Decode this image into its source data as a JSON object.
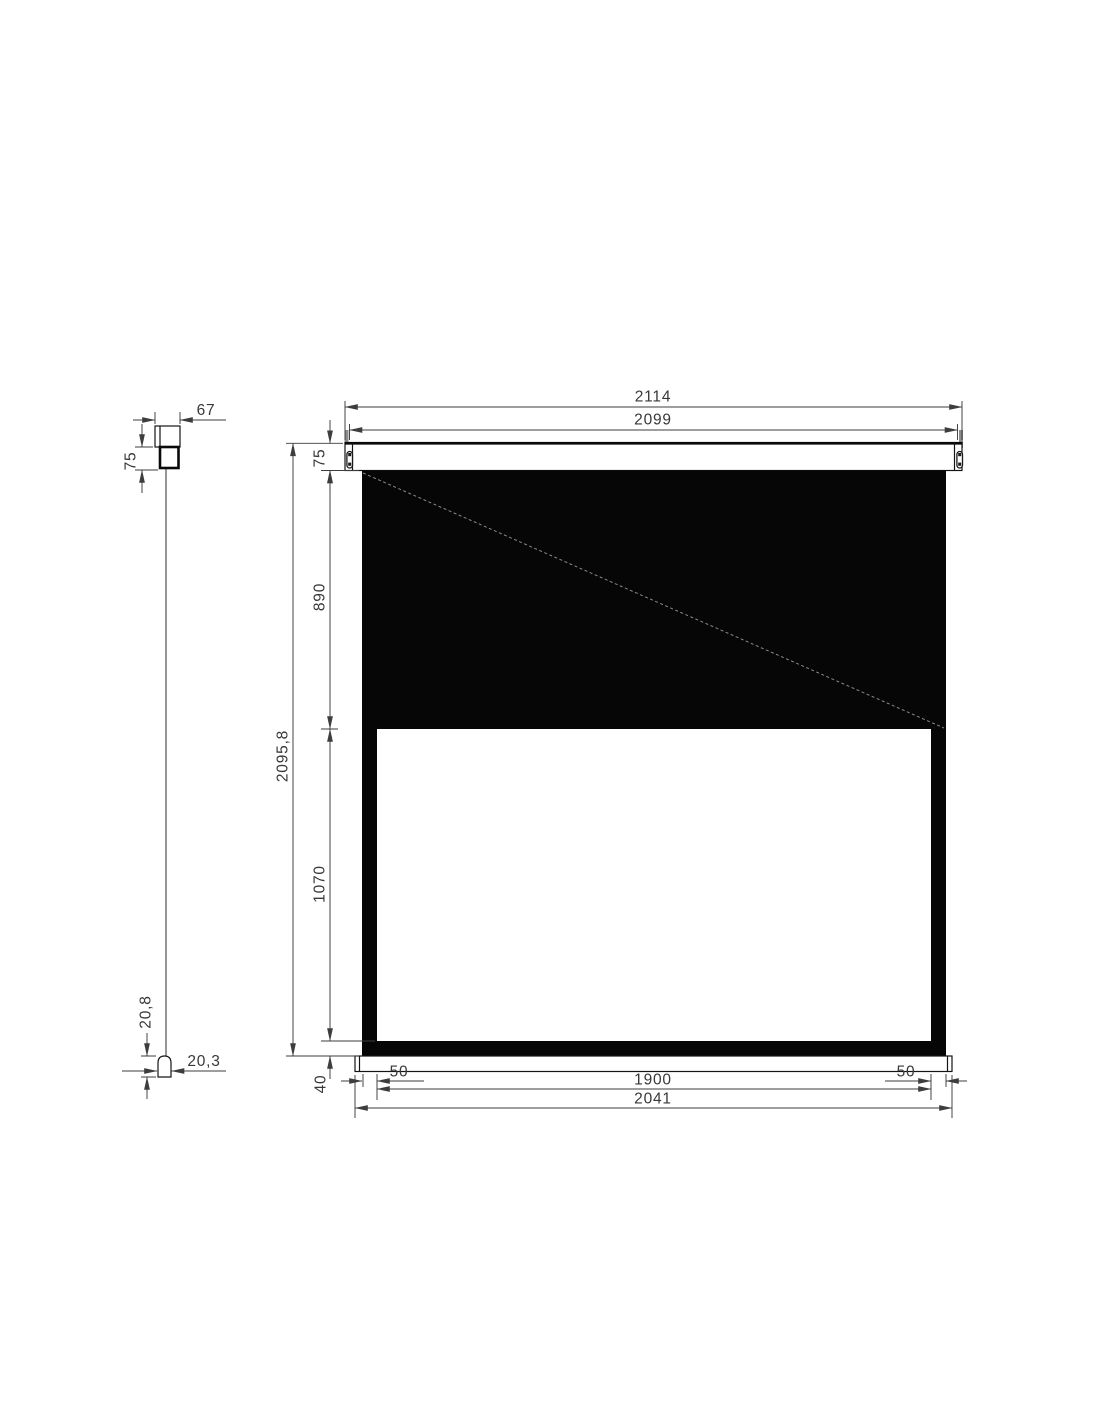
{
  "drawing": {
    "title": "Projection screen dimensional drawing",
    "units": "mm",
    "views": {
      "side": "side profile",
      "front": "front elevation"
    }
  },
  "colors": {
    "fabric_black": "#060606",
    "line": "#141414",
    "dimension": "#3d3d3d",
    "bracket_gray": "#8c8c8c"
  },
  "dims": {
    "side": {
      "bracket_width": "67",
      "casing_height": "75",
      "tip_height": "20,8",
      "tip_width": "20,3"
    },
    "front": {
      "total_width": "2114",
      "case_width": "2099",
      "case_height": "75",
      "black_drop": "890",
      "total_height": "2095,8",
      "view_height": "1070",
      "bottom_bar": "40",
      "left_border": "50",
      "view_width": "1900",
      "right_border": "50",
      "bar_width": "2041"
    }
  }
}
